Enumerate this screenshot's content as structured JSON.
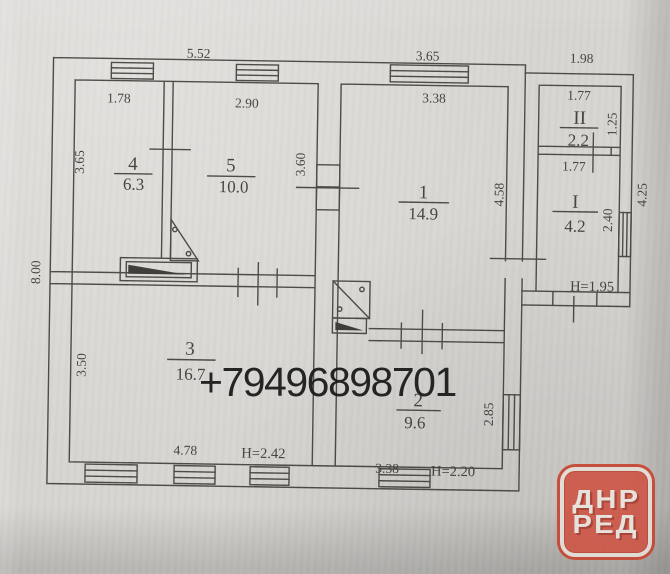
{
  "photo": {
    "phone_watermark": "+79496898701",
    "logo": {
      "line1": "ДНР",
      "line2": "РЕД",
      "fill": "#cd594a",
      "ring": "#c64836",
      "text": "#e9e5de"
    }
  },
  "plan": {
    "rooms": {
      "r4": {
        "num": "4",
        "area": "6.3"
      },
      "r5": {
        "num": "5",
        "area": "10.0"
      },
      "r3": {
        "num": "3",
        "area": "16.7"
      },
      "r1": {
        "num": "1",
        "area": "14.9"
      },
      "r2": {
        "num": "2",
        "area": "9.6"
      },
      "rII": {
        "num": "II",
        "area": "2.2"
      },
      "rI": {
        "num": "I",
        "area": "4.2"
      }
    },
    "dims": {
      "top_left": "5.52",
      "top_mid": "3.65",
      "top_right": "1.98",
      "left_total": "8.00",
      "r4_w": "1.78",
      "r5_w": "2.90",
      "r4_h": "3.65",
      "r5_h": "3.60",
      "r1_w": "3.38",
      "r1_h": "4.58",
      "rII_w": "1.77",
      "rII_h": "1.25",
      "rI_w": "1.77",
      "rI_h": "2.40",
      "annex_h": "4.25",
      "r3_h": "3.50",
      "r3_w": "4.78",
      "r3_height": "H=2.42",
      "r2_w": "3.38",
      "r2_h": "2.85",
      "r2_height": "H=2.20",
      "annex_height": "H=1.95"
    }
  }
}
